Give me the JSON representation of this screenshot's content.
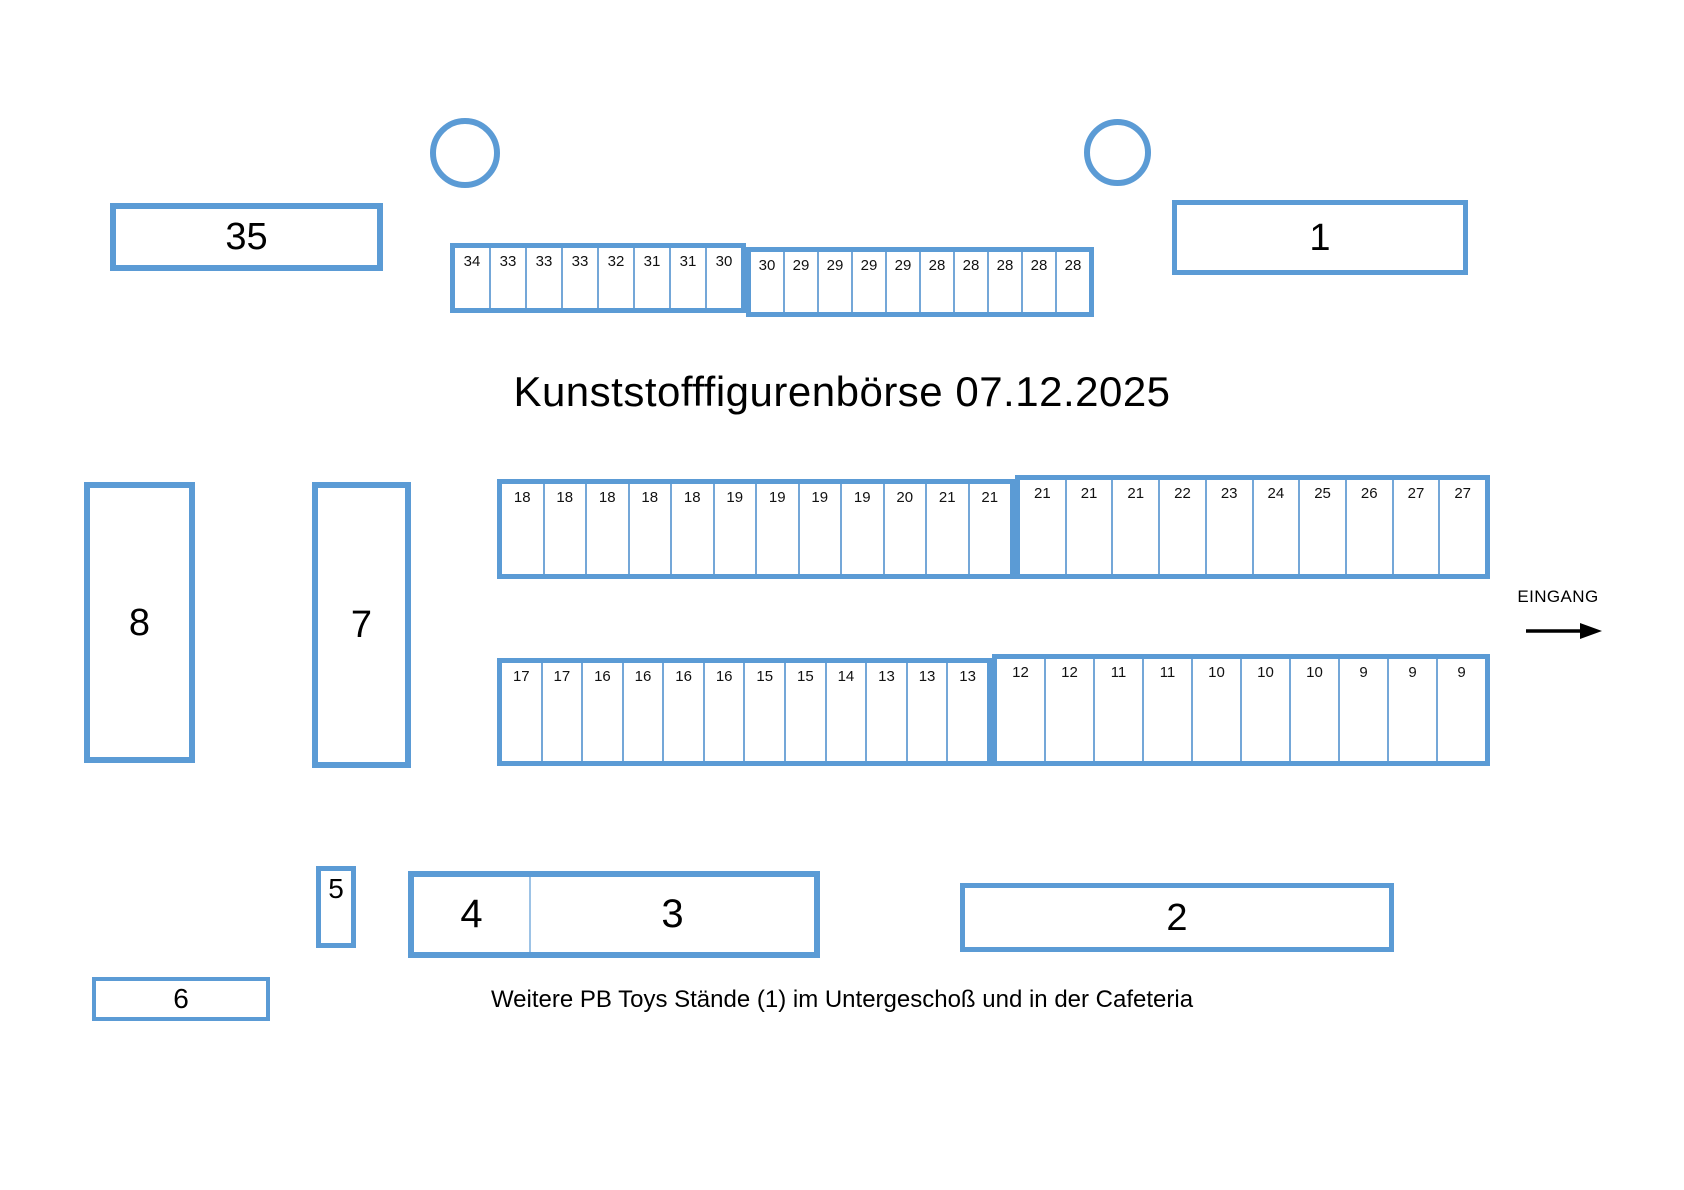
{
  "title": "Kunststofffigurenbörse 07.12.2025",
  "footer_note": "Weitere PB Toys Stände (1) im Untergeschoß und in der Cafeteria",
  "entrance": {
    "label": "EINGANG",
    "arrow_icon": "right-arrow"
  },
  "colors": {
    "accent": "#5B9BD5",
    "text": "#000000",
    "background": "#FFFFFF"
  },
  "booths": {
    "b35": {
      "label": "35"
    },
    "b1": {
      "label": "1"
    },
    "b8": {
      "label": "8"
    },
    "b7": {
      "label": "7"
    },
    "b5": {
      "label": "5"
    },
    "b4": {
      "label": "4"
    },
    "b3": {
      "label": "3"
    },
    "b2": {
      "label": "2"
    },
    "b6": {
      "label": "6"
    }
  },
  "stand_rows": {
    "top": {
      "groups": [
        [
          "34",
          "33",
          "33",
          "33",
          "32",
          "31",
          "31",
          "30"
        ],
        [
          "30",
          "29",
          "29",
          "29",
          "29",
          "28",
          "28",
          "28",
          "28",
          "28"
        ]
      ]
    },
    "middle_upper": {
      "groups": [
        [
          "18",
          "18",
          "18",
          "18",
          "18",
          "19",
          "19",
          "19",
          "19",
          "20",
          "21",
          "21"
        ],
        [
          "21",
          "21",
          "21",
          "22",
          "23",
          "24",
          "25",
          "26",
          "27",
          "27"
        ]
      ]
    },
    "middle_lower": {
      "groups": [
        [
          "17",
          "17",
          "16",
          "16",
          "16",
          "16",
          "15",
          "15",
          "14",
          "13",
          "13",
          "13"
        ],
        [
          "12",
          "12",
          "11",
          "11",
          "10",
          "10",
          "10",
          "9",
          "9",
          "9"
        ]
      ]
    }
  }
}
